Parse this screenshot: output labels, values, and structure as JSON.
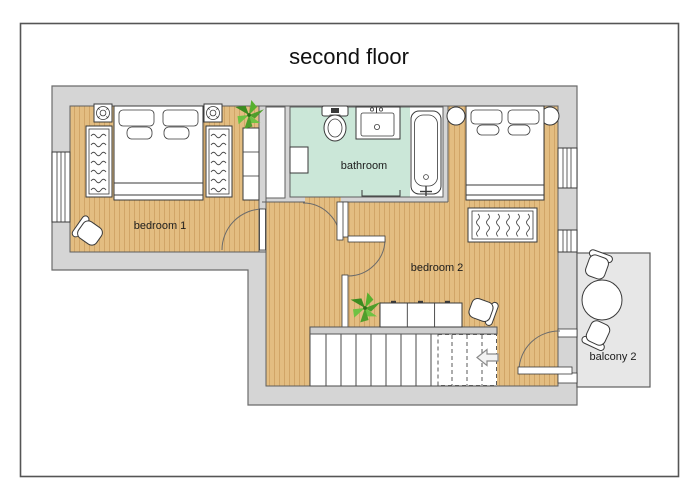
{
  "title": "second floor",
  "rooms": {
    "bedroom1": {
      "label": "bedroom 1",
      "furniture": [
        "double bed",
        "nightstand with lamp x2",
        "wardrobe x2",
        "tall cabinet",
        "armchair",
        "plant",
        "window"
      ]
    },
    "bedroom2": {
      "label": "bedroom 2",
      "furniture": [
        "double bed",
        "round side table x2",
        "rug",
        "sideboard",
        "armchair",
        "plant",
        "window x2",
        "balcony door"
      ]
    },
    "bathroom": {
      "label": "bathroom",
      "furniture": [
        "toilet",
        "vanity sink",
        "bathtub",
        "cabinet",
        "towel rail"
      ]
    },
    "balcony2": {
      "label": "balcony 2",
      "furniture": [
        "round table",
        "chair x2"
      ]
    },
    "landing": {
      "label": "",
      "furniture": [
        "staircase",
        "direction arrow"
      ]
    }
  },
  "icons": {
    "stairs_direction": "left-arrow",
    "nightstand_lamp": "lamp-icon",
    "plant": "plant-icon"
  },
  "colors": {
    "wall": "#d5d5d5",
    "wood_floor": "#e3bd81",
    "wood_plank_line": "#d1a567",
    "bathroom_floor": "#cbe7d8",
    "balcony_floor": "#e7e7e7",
    "furniture": "#ffffff",
    "plant_green": "#4f9e2b",
    "frame": "#555555"
  }
}
